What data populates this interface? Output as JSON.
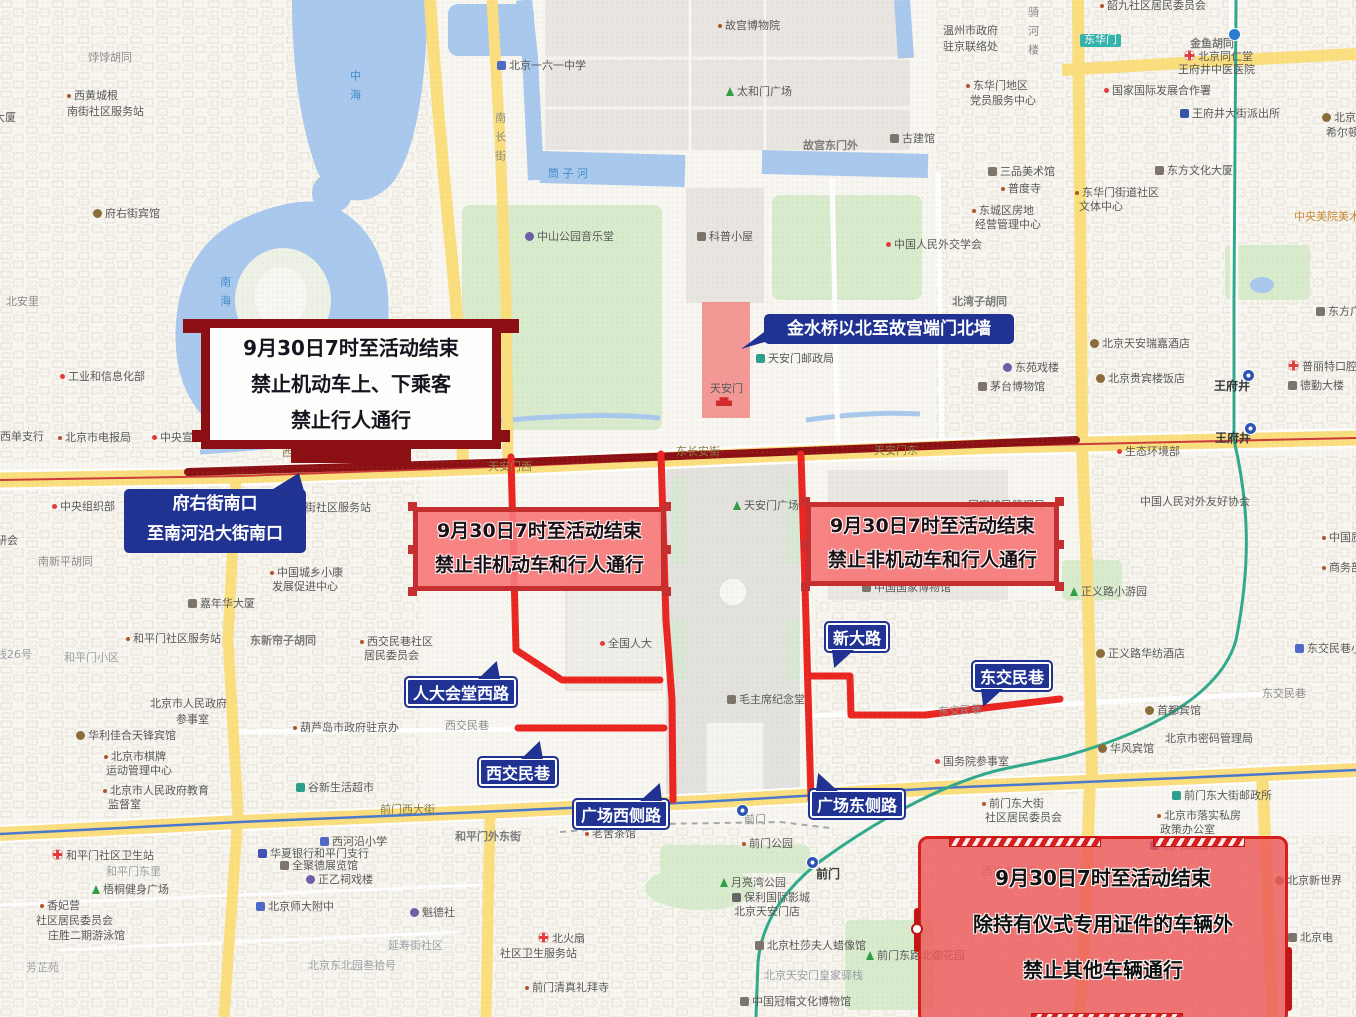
{
  "colors": {
    "map_background": "#f8f6f0",
    "water": "#a9c8ee",
    "park_green": "#d8eccd",
    "road_yellow": "#fbdf7e",
    "closure_red": "#ea2420",
    "changan_closure_maroon": "#8c1013",
    "callout_blue": "#203292",
    "ban_box_fill": "#f47878",
    "ban_box_border": "#c62f2f",
    "south_box_border": "#d61f1f",
    "metro_green": "#2ea98c",
    "metro_blue": "#4a78cc",
    "restricted_zone_fill": "#f05d5d"
  },
  "callouts": {
    "changan_ban": {
      "lines": [
        "9月30日7时至活动结束",
        "禁止机动车上、下乘客",
        "禁止行人通行"
      ]
    },
    "changan_range": {
      "lines": [
        "府右街南口",
        "至南河沿大街南口"
      ]
    },
    "jinshui": {
      "text": "金水桥以北至故宫端门北墙"
    },
    "west_ban": {
      "lines": [
        "9月30日7时至活动结束",
        "禁止非机动车和行人通行"
      ]
    },
    "east_ban": {
      "lines": [
        "9月30日7时至活动结束",
        "禁止非机动车和行人通行"
      ]
    },
    "south_ban": {
      "lines": [
        "9月30日7时至活动结束",
        "除持有仪式专用证件的车辆外",
        "禁止其他车辆通行"
      ]
    },
    "road_tags": {
      "renmin_west": "人大会堂西路",
      "xijiaominxiang": "西交民巷",
      "square_west": "广场西侧路",
      "square_east": "广场东侧路",
      "xindalu": "新大路",
      "dongjiaominxiang": "东交民巷"
    }
  },
  "map_labels": [
    {
      "t": "饽饽胡同",
      "x": 88,
      "y": 52,
      "c": "road"
    },
    {
      "t": "西黄城根",
      "x": 67,
      "y": 90,
      "c": "poi",
      "i": "dot"
    },
    {
      "t": "南街社区服务站",
      "x": 67,
      "y": 106,
      "c": "poi"
    },
    {
      "t": "大厦",
      "x": -6,
      "y": 112,
      "c": "poi"
    },
    {
      "t": "府右街宾馆",
      "x": 93,
      "y": 208,
      "c": "poi",
      "i": "hotel"
    },
    {
      "t": "中海",
      "x": 348,
      "y": 70,
      "c": "water",
      "v": 1
    },
    {
      "t": "南海",
      "x": 218,
      "y": 276,
      "c": "water",
      "v": 1
    },
    {
      "t": "北安里",
      "x": 6,
      "y": 296,
      "c": "road"
    },
    {
      "t": "工业和信息化部",
      "x": 60,
      "y": 371,
      "c": "poi",
      "i": "dot-red"
    },
    {
      "t": "西单支行",
      "x": 0,
      "y": 431,
      "c": "poi"
    },
    {
      "t": "北京市电报局",
      "x": 58,
      "y": 432,
      "c": "poi",
      "i": "dot"
    },
    {
      "t": "中央宣传部",
      "x": 152,
      "y": 432,
      "c": "poi",
      "i": "dot-red"
    },
    {
      "t": "中央组织部",
      "x": 52,
      "y": 501,
      "c": "poi",
      "i": "dot-red"
    },
    {
      "t": "研会",
      "x": -4,
      "y": 535,
      "c": "poi"
    },
    {
      "t": "南新平胡同",
      "x": 38,
      "y": 556,
      "c": "road"
    },
    {
      "t": "南长街",
      "x": 493,
      "y": 112,
      "c": "road",
      "v": 1
    },
    {
      "t": "骑河楼",
      "x": 1026,
      "y": 6,
      "c": "road",
      "v": 1
    },
    {
      "t": "故宫博物院",
      "x": 718,
      "y": 20,
      "c": "poi",
      "i": "dot"
    },
    {
      "t": "北京一六一中学",
      "x": 497,
      "y": 60,
      "c": "poi",
      "i": "school"
    },
    {
      "t": "太和门广场",
      "x": 726,
      "y": 86,
      "c": "poi",
      "i": "tree"
    },
    {
      "t": "故宫东门外",
      "x": 803,
      "y": 140,
      "c": "roadbold"
    },
    {
      "t": "古建馆",
      "x": 890,
      "y": 133,
      "c": "poi",
      "i": "museum"
    },
    {
      "t": "筒 子 河",
      "x": 548,
      "y": 168,
      "c": "water"
    },
    {
      "t": "中山公园音乐堂",
      "x": 525,
      "y": 231,
      "c": "poi",
      "i": "music"
    },
    {
      "t": "科普小屋",
      "x": 697,
      "y": 231,
      "c": "poi",
      "i": "museum"
    },
    {
      "t": "中国人民外交学会",
      "x": 886,
      "y": 239,
      "c": "poi",
      "i": "dot-red"
    },
    {
      "t": "北湾子胡同",
      "x": 952,
      "y": 296,
      "c": "roadbold"
    },
    {
      "t": "天安门邮政局",
      "x": 756,
      "y": 353,
      "c": "poi",
      "i": "postal"
    },
    {
      "t": "东苑戏楼",
      "x": 1003,
      "y": 362,
      "c": "poi",
      "i": "music"
    },
    {
      "t": "茅台博物馆",
      "x": 978,
      "y": 381,
      "c": "poi",
      "i": "museum"
    },
    {
      "t": "天安门",
      "x": 710,
      "y": 383,
      "c": "poi"
    },
    {
      "t": "",
      "x": 716,
      "y": 396,
      "i": "gate"
    },
    {
      "t": "韶九社区居民委员会",
      "x": 1100,
      "y": 0,
      "c": "poi",
      "i": "dot"
    },
    {
      "t": "东华门",
      "x": 1080,
      "y": 34,
      "c": "chip"
    },
    {
      "t": "金鱼胡同",
      "x": 1190,
      "y": 38,
      "c": "roadbold"
    },
    {
      "t": "北京同仁堂",
      "x": 1184,
      "y": 50,
      "c": "poi",
      "i": "cross"
    },
    {
      "t": "王府井中医医院",
      "x": 1178,
      "y": 64,
      "c": "poi"
    },
    {
      "t": "温州市政府",
      "x": 943,
      "y": 25,
      "c": "poi"
    },
    {
      "t": "驻京联络处",
      "x": 943,
      "y": 41,
      "c": "poi"
    },
    {
      "t": "东华门地区",
      "x": 966,
      "y": 80,
      "c": "poi",
      "i": "dot"
    },
    {
      "t": "党员服务中心",
      "x": 970,
      "y": 95,
      "c": "poi"
    },
    {
      "t": "国家国际发展合作署",
      "x": 1104,
      "y": 85,
      "c": "poi",
      "i": "dot-red"
    },
    {
      "t": "王府井大街派出所",
      "x": 1180,
      "y": 108,
      "c": "poi",
      "i": "police"
    },
    {
      "t": "北京王府井",
      "x": 1322,
      "y": 112,
      "c": "poi",
      "i": "hotel"
    },
    {
      "t": "希尔顿酒店",
      "x": 1326,
      "y": 127,
      "c": "poi"
    },
    {
      "t": "三品美术馆",
      "x": 988,
      "y": 166,
      "c": "poi",
      "i": "museum"
    },
    {
      "t": "普度寺",
      "x": 1001,
      "y": 183,
      "c": "poi",
      "i": "dot"
    },
    {
      "t": "东方文化大厦",
      "x": 1155,
      "y": 165,
      "c": "poi",
      "i": "building"
    },
    {
      "t": "东华门街道社区",
      "x": 1075,
      "y": 187,
      "c": "poi",
      "i": "dot"
    },
    {
      "t": "文体中心",
      "x": 1079,
      "y": 201,
      "c": "poi"
    },
    {
      "t": "东城区房地",
      "x": 972,
      "y": 205,
      "c": "poi",
      "i": "dot"
    },
    {
      "t": "经营管理中心",
      "x": 975,
      "y": 219,
      "c": "poi"
    },
    {
      "t": "中央美院美术馆",
      "x": 1294,
      "y": 211,
      "c": "org"
    },
    {
      "t": "北京天安瑞嘉酒店",
      "x": 1090,
      "y": 338,
      "c": "poi",
      "i": "hotel"
    },
    {
      "t": "北京贵宾楼饭店",
      "x": 1096,
      "y": 373,
      "c": "poi",
      "i": "hotel"
    },
    {
      "t": "东方广场",
      "x": 1316,
      "y": 306,
      "c": "poi",
      "i": "building"
    },
    {
      "t": "普丽特口腔",
      "x": 1288,
      "y": 360,
      "c": "poi",
      "i": "cross"
    },
    {
      "t": "德勤大楼",
      "x": 1288,
      "y": 380,
      "c": "poi",
      "i": "building"
    },
    {
      "t": "王府井",
      "x": 1214,
      "y": 380,
      "c": "station"
    },
    {
      "t": "王府井",
      "x": 1215,
      "y": 432,
      "c": "station"
    },
    {
      "t": "",
      "x": 1242,
      "y": 369,
      "i": "metro"
    },
    {
      "t": "",
      "x": 1244,
      "y": 422,
      "i": "metro"
    },
    {
      "t": "",
      "x": 1228,
      "y": 28,
      "i": "metroD"
    },
    {
      "t": "生态环境部",
      "x": 1117,
      "y": 446,
      "c": "poi",
      "i": "dot-red"
    },
    {
      "t": "中国人民对外友好协会",
      "x": 1140,
      "y": 496,
      "c": "poi"
    },
    {
      "t": "正义路小游园",
      "x": 1070,
      "y": 586,
      "c": "poi",
      "i": "tree"
    },
    {
      "t": "正义路华纺酒店",
      "x": 1096,
      "y": 648,
      "c": "poi",
      "i": "hotel"
    },
    {
      "t": "东交民巷小学",
      "x": 1295,
      "y": 643,
      "c": "poi",
      "i": "school"
    },
    {
      "t": "东交民巷",
      "x": 1262,
      "y": 688,
      "c": "road"
    },
    {
      "t": "中国质量",
      "x": 1322,
      "y": 532,
      "c": "poi",
      "i": "dot"
    },
    {
      "t": "商务部",
      "x": 1322,
      "y": 562,
      "c": "poi",
      "i": "dot"
    },
    {
      "t": "首都宾馆",
      "x": 1145,
      "y": 705,
      "c": "poi",
      "i": "hotel"
    },
    {
      "t": "华风宾馆",
      "x": 1098,
      "y": 743,
      "c": "poi",
      "i": "hotel"
    },
    {
      "t": "北京市密码管理局",
      "x": 1165,
      "y": 733,
      "c": "poi"
    },
    {
      "t": "国务院参事室",
      "x": 935,
      "y": 756,
      "c": "poi",
      "i": "dot-red"
    },
    {
      "t": "西长安街",
      "x": 282,
      "y": 447,
      "c": "onroad"
    },
    {
      "t": "东长安街",
      "x": 676,
      "y": 446,
      "c": "onroad"
    },
    {
      "t": "天安门西",
      "x": 488,
      "y": 461,
      "c": "onroad"
    },
    {
      "t": "天安门东",
      "x": 874,
      "y": 445,
      "c": "onroad"
    },
    {
      "t": "天安门广场",
      "x": 733,
      "y": 500,
      "c": "poi",
      "i": "tree"
    },
    {
      "t": "全国人大",
      "x": 600,
      "y": 638,
      "c": "poi",
      "i": "dot-red"
    },
    {
      "t": "毛主席纪念堂",
      "x": 727,
      "y": 694,
      "c": "poi",
      "i": "museum"
    },
    {
      "t": "西交民巷",
      "x": 445,
      "y": 720,
      "c": "road"
    },
    {
      "t": "东交民巷",
      "x": 938,
      "y": 705,
      "c": "road",
      "r": -4
    },
    {
      "t": "国家移民管理局",
      "x": 960,
      "y": 500,
      "c": "poi",
      "i": "dot-red"
    },
    {
      "t": "中国国家博物馆",
      "x": 862,
      "y": 582,
      "c": "poi",
      "i": "museum"
    },
    {
      "t": "北新华街社区服务站",
      "x": 272,
      "y": 502,
      "c": "poi"
    },
    {
      "t": "中国城乡小康",
      "x": 270,
      "y": 567,
      "c": "poi",
      "i": "dot"
    },
    {
      "t": "发展促进中心",
      "x": 272,
      "y": 581,
      "c": "poi"
    },
    {
      "t": "嘉年华大厦",
      "x": 188,
      "y": 598,
      "c": "poi",
      "i": "building"
    },
    {
      "t": "东新帘子胡同",
      "x": 250,
      "y": 635,
      "c": "roadbold"
    },
    {
      "t": "西交民巷社区",
      "x": 360,
      "y": 636,
      "c": "poi",
      "i": "dot"
    },
    {
      "t": "居民委员会",
      "x": 364,
      "y": 650,
      "c": "poi"
    },
    {
      "t": "和平门社区服务站",
      "x": 126,
      "y": 633,
      "c": "poi",
      "i": "dot"
    },
    {
      "t": "和平门小区",
      "x": 64,
      "y": 652,
      "c": "area"
    },
    {
      "t": "线26号",
      "x": -4,
      "y": 649,
      "c": "area"
    },
    {
      "t": "北京市人民政府",
      "x": 150,
      "y": 698,
      "c": "poi"
    },
    {
      "t": "参事室",
      "x": 176,
      "y": 714,
      "c": "poi"
    },
    {
      "t": "葫芦岛市政府驻京办",
      "x": 293,
      "y": 722,
      "c": "poi",
      "i": "dot"
    },
    {
      "t": "华利佳合天锋宾馆",
      "x": 76,
      "y": 730,
      "c": "poi",
      "i": "hotel"
    },
    {
      "t": "北京市棋牌",
      "x": 104,
      "y": 751,
      "c": "poi",
      "i": "dot"
    },
    {
      "t": "运动管理中心",
      "x": 106,
      "y": 765,
      "c": "poi"
    },
    {
      "t": "北京市人民政府教育",
      "x": 103,
      "y": 785,
      "c": "poi",
      "i": "dot"
    },
    {
      "t": "监督室",
      "x": 108,
      "y": 799,
      "c": "poi"
    },
    {
      "t": "谷新生活超市",
      "x": 296,
      "y": 782,
      "c": "poi",
      "i": "shop"
    },
    {
      "t": "前门西大街",
      "x": 380,
      "y": 804,
      "c": "onroad"
    },
    {
      "t": "和平门外东街",
      "x": 455,
      "y": 831,
      "c": "roadbold"
    },
    {
      "t": "老舍茶馆",
      "x": 585,
      "y": 828,
      "c": "poi",
      "i": "dot"
    },
    {
      "t": "西河沿小学",
      "x": 320,
      "y": 836,
      "c": "poi",
      "i": "school"
    },
    {
      "t": "华夏银行和平门支行",
      "x": 258,
      "y": 848,
      "c": "poi",
      "i": "bank"
    },
    {
      "t": "全聚德展览馆",
      "x": 280,
      "y": 860,
      "c": "poi",
      "i": "museum"
    },
    {
      "t": "正乙祠戏楼",
      "x": 306,
      "y": 874,
      "c": "poi",
      "i": "music"
    },
    {
      "t": "北京师大附中",
      "x": 256,
      "y": 901,
      "c": "poi",
      "i": "school"
    },
    {
      "t": "魁德社",
      "x": 410,
      "y": 907,
      "c": "poi",
      "i": "music"
    },
    {
      "t": "延寿街社区",
      "x": 388,
      "y": 940,
      "c": "area"
    },
    {
      "t": "北京东北园叁拾号",
      "x": 308,
      "y": 960,
      "c": "area"
    },
    {
      "t": "北火扇",
      "x": 538,
      "y": 932,
      "c": "poi",
      "i": "cross"
    },
    {
      "t": "社区卫生服务站",
      "x": 500,
      "y": 948,
      "c": "poi"
    },
    {
      "t": "前门清真礼拜寺",
      "x": 525,
      "y": 982,
      "c": "poi",
      "i": "dot"
    },
    {
      "t": "和平门社区卫生站",
      "x": 52,
      "y": 849,
      "c": "poi",
      "i": "cross"
    },
    {
      "t": "和平门东里",
      "x": 106,
      "y": 866,
      "c": "area"
    },
    {
      "t": "梧桐健身广场",
      "x": 92,
      "y": 884,
      "c": "poi",
      "i": "tree"
    },
    {
      "t": "香妃营",
      "x": 40,
      "y": 900,
      "c": "poi",
      "i": "dot"
    },
    {
      "t": "社区居民委员会",
      "x": 36,
      "y": 915,
      "c": "poi"
    },
    {
      "t": "庄胜二期游泳馆",
      "x": 48,
      "y": 930,
      "c": "poi"
    },
    {
      "t": "芳芷苑",
      "x": 26,
      "y": 962,
      "c": "area"
    },
    {
      "t": "前门",
      "x": 744,
      "y": 814,
      "c": "road"
    },
    {
      "t": "前门公园",
      "x": 742,
      "y": 838,
      "c": "poi",
      "i": "dot"
    },
    {
      "t": "月亮湾公园",
      "x": 720,
      "y": 877,
      "c": "poi",
      "i": "tree"
    },
    {
      "t": "保利国际影城",
      "x": 732,
      "y": 892,
      "c": "poi",
      "i": "cinema"
    },
    {
      "t": "北京天安门店",
      "x": 734,
      "y": 906,
      "c": "poi"
    },
    {
      "t": "前门",
      "x": 816,
      "y": 868,
      "c": "station"
    },
    {
      "t": "",
      "x": 736,
      "y": 804,
      "i": "metro"
    },
    {
      "t": "",
      "x": 806,
      "y": 856,
      "i": "metro"
    },
    {
      "t": "北京杜莎夫人蜡像馆",
      "x": 755,
      "y": 940,
      "c": "poi",
      "i": "museum"
    },
    {
      "t": "北京天安门皇家驿栈",
      "x": 764,
      "y": 970,
      "c": "area"
    },
    {
      "t": "中国冠帽文化博物馆",
      "x": 740,
      "y": 996,
      "c": "poi",
      "i": "museum"
    },
    {
      "t": "前门东路北御花园",
      "x": 866,
      "y": 950,
      "c": "poi",
      "i": "tree"
    },
    {
      "t": "前门东大街",
      "x": 982,
      "y": 798,
      "c": "poi",
      "i": "dot"
    },
    {
      "t": "社区居民委员会",
      "x": 985,
      "y": 812,
      "c": "poi"
    },
    {
      "t": "前门东大街邮政所",
      "x": 1172,
      "y": 790,
      "c": "poi",
      "i": "postal"
    },
    {
      "t": "北京市落实私房",
      "x": 1157,
      "y": 810,
      "c": "poi",
      "i": "dot"
    },
    {
      "t": "政策办公室",
      "x": 1160,
      "y": 824,
      "c": "poi"
    },
    {
      "t": "前门派出所",
      "x": 1150,
      "y": 840,
      "c": "poi",
      "i": "police"
    },
    {
      "t": "西打磨厂街",
      "x": 982,
      "y": 866,
      "c": "area"
    },
    {
      "t": "北京新世界",
      "x": 1275,
      "y": 875,
      "c": "poi",
      "i": "hotel"
    },
    {
      "t": "北京电",
      "x": 1288,
      "y": 932,
      "c": "poi",
      "i": "building"
    }
  ]
}
